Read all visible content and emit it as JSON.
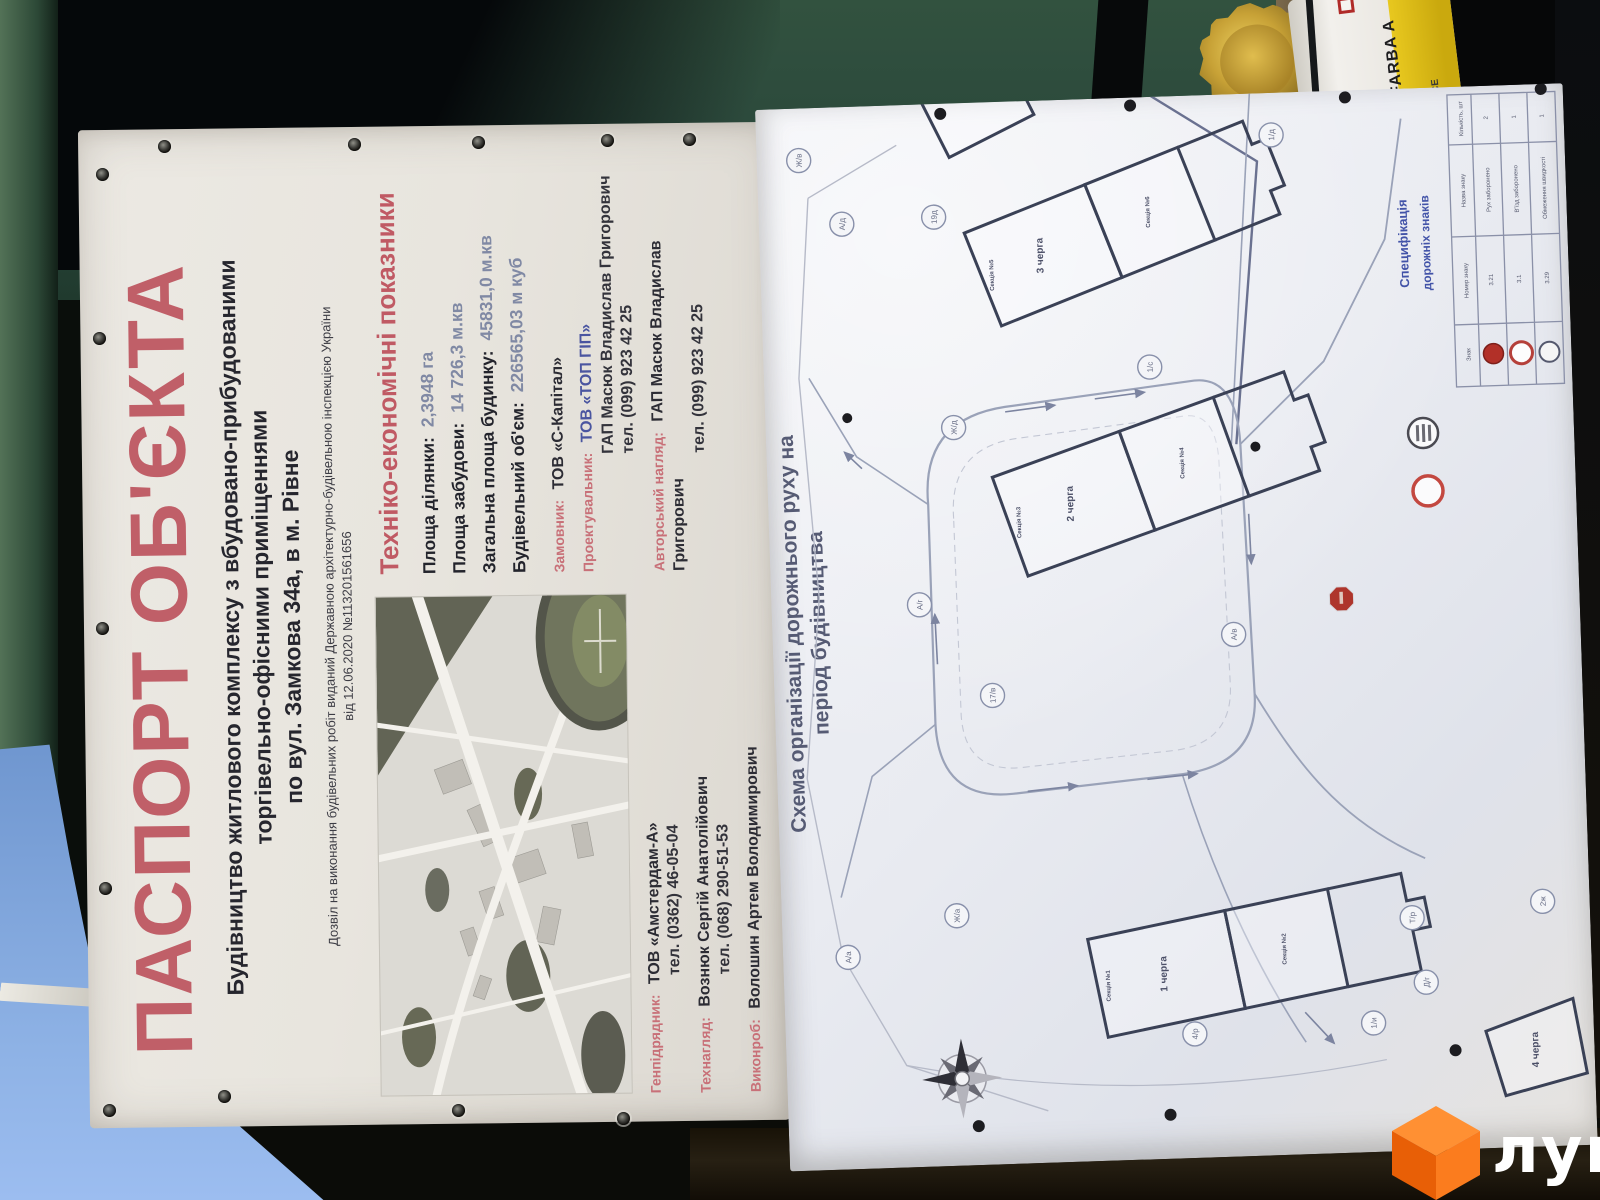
{
  "watermark": {
    "brand": "лун"
  },
  "paint_can": {
    "label": "FARBA A",
    "marks": "CE"
  },
  "passport": {
    "title": "ПАСПОРТ ОБ'ЄКТА",
    "subtitle_lines": [
      "Будівництво житлового комплексу з вбудовано-прибудованими",
      "торгівельно-офісними приміщеннями",
      "по вул. Замкова 34а, в м. Рівне"
    ],
    "permit_line1": "Дозвіл на виконання будівельних робіт виданий Державною архітектурно-будівельною інспекцією України",
    "permit_line2": "від 12.06.2020 №113201561656",
    "indicators": {
      "heading": "Техніко-економічні показники",
      "rows": [
        {
          "label": "Площа ділянки:",
          "value": "2,3948 га"
        },
        {
          "label": "Площа забудови:",
          "value": "14 726,3 м.кв"
        },
        {
          "label": "Загальна площа будинку:",
          "value": "45831,0 м.кв"
        },
        {
          "label": "Будівельний об'єм:",
          "value": "226565,03 м куб"
        }
      ]
    },
    "customer_label": "Замовник:",
    "customer_value": "ТОВ «С-Капітал»",
    "designer_label": "Проектувальник:",
    "designer_org": "ТОВ «ТОП ГІП»",
    "designer_person": "ГАП Масюк Владислав Григорович",
    "designer_phone": "тел. (099) 923 42 25",
    "author_label": "Авторський нагляд:",
    "author_person": "ГАП Масюк Владислав Григорович",
    "author_phone": "тел. (099) 923 42 25",
    "contractor_label": "Генпідрядник:",
    "contractor_org": "ТОВ «Амстердам-А»",
    "contractor_phone": "тел. (0362) 46-05-04",
    "tech_label": "Технагляд:",
    "tech_person": "Вознюк Сергій Анатолійович",
    "tech_phone": "тел. (068) 290-51-53",
    "foreman_label": "Виконроб:",
    "foreman_person": "Волошин Артем Володимирович"
  },
  "plan": {
    "title_line1": "Схема організації дорожнього руху на",
    "title_line2": "період будівництва",
    "spec_title_line1": "Специфікація",
    "spec_title_line2": "дорожніх знаків",
    "spec_col_sign": "Знак",
    "spec_col_num": "Номер знаку",
    "spec_col_name": "Назва знаку",
    "spec_col_qty": "Кількість, шт",
    "spec_rows": [
      {
        "name": "Рух заборонено",
        "num": "3.21",
        "qty": "2"
      },
      {
        "name": "В'їзд заборонено",
        "num": "3.1",
        "qty": "1"
      },
      {
        "name": "Обмеження швидкості",
        "num": "3.29",
        "qty": "1"
      }
    ],
    "phase1": "1 черга",
    "phase2": "2 черга",
    "phase3": "3 черга",
    "phase4": "4 черга",
    "sec1": "Секція №1",
    "sec2": "Секція №2",
    "sec3": "Секція №3",
    "sec4": "Секція №4",
    "sec5": "Секція №5",
    "sec6": "Секція №6",
    "node_labels": [
      "Ж/в",
      "А/д",
      "19д",
      "1/д",
      "1/с",
      "Ж/д",
      "А/г",
      "17/в",
      "А/в",
      "Ж/а",
      "А/а",
      "4/р",
      "1/и",
      "Т/р",
      "Д/г",
      "2ж"
    ]
  }
}
